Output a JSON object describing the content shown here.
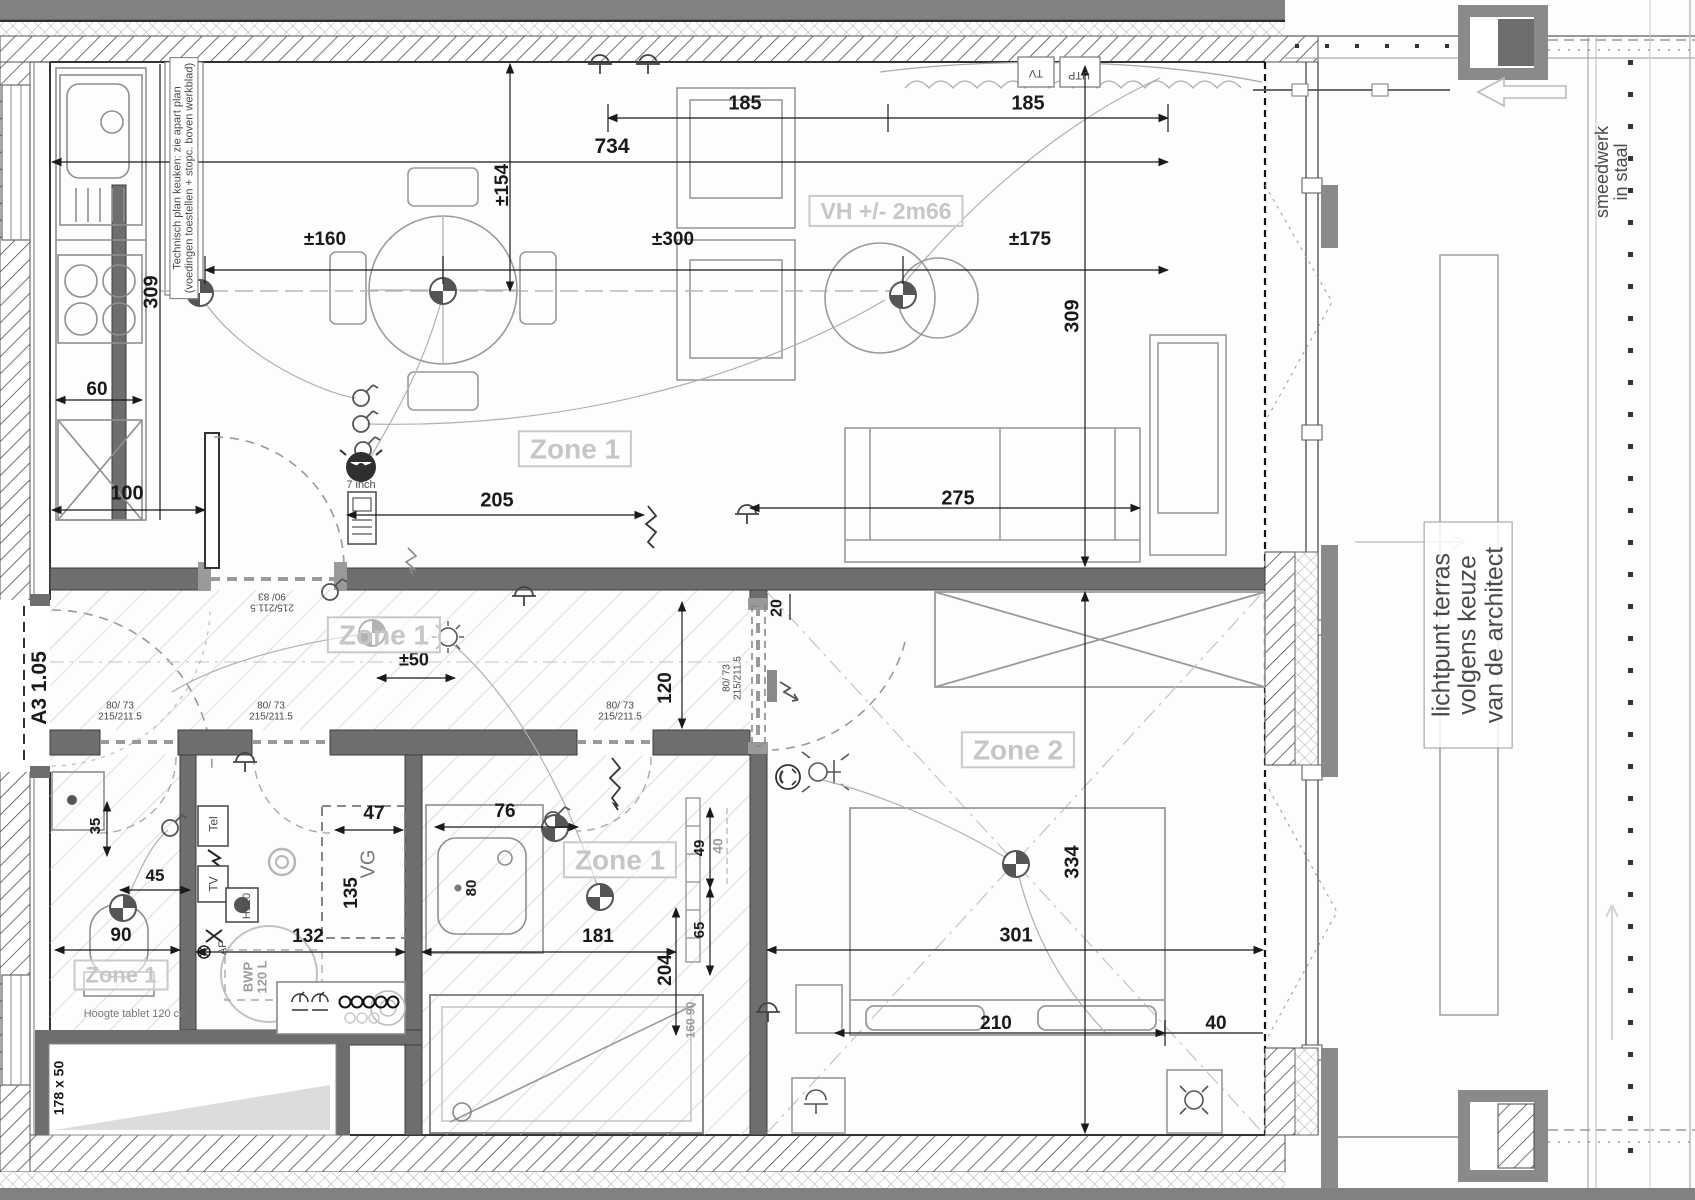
{
  "drawing": {
    "type": "architectural floor plan - apartment electrical / technical plan",
    "scale_note": "dimensions in cm",
    "colors": {
      "wall_fill": "#6e6e6e",
      "outer_band": "#818181",
      "dim_text": "#1a1a1a",
      "zone_text": "#c6c6c6",
      "grey_text": "#9b9b9b",
      "furniture_line": "#999999"
    }
  },
  "labels": [
    {
      "id": "dim-185-left",
      "text": "185",
      "x": 745,
      "y": 104,
      "rot": 0,
      "size": 20,
      "cls": "c-dim"
    },
    {
      "id": "dim-185-right",
      "text": "185",
      "x": 1028,
      "y": 104,
      "rot": 0,
      "size": 20,
      "cls": "c-dim"
    },
    {
      "id": "dim-734",
      "text": "734",
      "x": 612,
      "y": 147,
      "rot": 0,
      "size": 21,
      "cls": "c-dim"
    },
    {
      "id": "dim-154",
      "text": "±154",
      "x": 503,
      "y": 185,
      "rot": -90,
      "size": 19,
      "cls": "c-dim"
    },
    {
      "id": "dim-160",
      "text": "±160",
      "x": 325,
      "y": 240,
      "rot": 0,
      "size": 19,
      "cls": "c-dim"
    },
    {
      "id": "dim-300",
      "text": "±300",
      "x": 673,
      "y": 240,
      "rot": 0,
      "size": 19,
      "cls": "c-dim"
    },
    {
      "id": "dim-175",
      "text": "±175",
      "x": 1030,
      "y": 240,
      "rot": 0,
      "size": 19,
      "cls": "c-dim"
    },
    {
      "id": "dim-309-left",
      "text": "309",
      "x": 152,
      "y": 292,
      "rot": -90,
      "size": 20,
      "cls": "c-dim"
    },
    {
      "id": "dim-309-right",
      "text": "309",
      "x": 1073,
      "y": 316,
      "rot": -90,
      "size": 20,
      "cls": "c-dim"
    },
    {
      "id": "dim-275",
      "text": "275",
      "x": 958,
      "y": 499,
      "rot": 0,
      "size": 20,
      "cls": "c-dim"
    },
    {
      "id": "dim-205",
      "text": "205",
      "x": 497,
      "y": 501,
      "rot": 0,
      "size": 20,
      "cls": "c-dim"
    },
    {
      "id": "dim-100",
      "text": "100",
      "x": 127,
      "y": 494,
      "rot": 0,
      "size": 20,
      "cls": "c-dim"
    },
    {
      "id": "dim-60",
      "text": "60",
      "x": 97,
      "y": 390,
      "rot": 0,
      "size": 19,
      "cls": "c-dim"
    },
    {
      "id": "dim-120-hall",
      "text": "120",
      "x": 666,
      "y": 688,
      "rot": -90,
      "size": 19,
      "cls": "c-dim"
    },
    {
      "id": "dim-20",
      "text": "20",
      "x": 778,
      "y": 608,
      "rot": -90,
      "size": 16,
      "cls": "c-dim"
    },
    {
      "id": "dim-50",
      "text": "±50",
      "x": 414,
      "y": 660,
      "rot": 0,
      "size": 18,
      "cls": "c-dim"
    },
    {
      "id": "dim-35",
      "text": "35",
      "x": 96,
      "y": 826,
      "rot": -90,
      "size": 15,
      "cls": "c-dim"
    },
    {
      "id": "dim-45",
      "text": "45",
      "x": 155,
      "y": 876,
      "rot": 0,
      "size": 17,
      "cls": "c-dim"
    },
    {
      "id": "dim-90",
      "text": "90",
      "x": 121,
      "y": 936,
      "rot": 0,
      "size": 19,
      "cls": "c-dim"
    },
    {
      "id": "dim-132",
      "text": "132",
      "x": 308,
      "y": 937,
      "rot": 0,
      "size": 19,
      "cls": "c-dim"
    },
    {
      "id": "dim-47",
      "text": "47",
      "x": 374,
      "y": 814,
      "rot": 0,
      "size": 19,
      "cls": "c-dim"
    },
    {
      "id": "dim-135",
      "text": "135",
      "x": 352,
      "y": 893,
      "rot": -90,
      "size": 19,
      "cls": "c-dim"
    },
    {
      "id": "dim-76",
      "text": "76",
      "x": 505,
      "y": 812,
      "rot": 0,
      "size": 19,
      "cls": "c-dim"
    },
    {
      "id": "dim-80",
      "text": "80",
      "x": 472,
      "y": 888,
      "rot": -90,
      "size": 15,
      "cls": "c-dim"
    },
    {
      "id": "dim-181",
      "text": "181",
      "x": 598,
      "y": 937,
      "rot": 0,
      "size": 19,
      "cls": "c-dim"
    },
    {
      "id": "dim-204",
      "text": "204",
      "x": 666,
      "y": 970,
      "rot": -90,
      "size": 19,
      "cls": "c-dim"
    },
    {
      "id": "dim-49",
      "text": "49",
      "x": 700,
      "y": 848,
      "rot": -90,
      "size": 15,
      "cls": "c-dim"
    },
    {
      "id": "dim-65",
      "text": "65",
      "x": 700,
      "y": 930,
      "rot": -90,
      "size": 15,
      "cls": "c-dim"
    },
    {
      "id": "dim-40-grey",
      "text": "40",
      "x": 718,
      "y": 846,
      "rot": -90,
      "size": 14,
      "cls": "c-grey"
    },
    {
      "id": "dim-160-90",
      "text": "160  90",
      "x": 691,
      "y": 1020,
      "rot": -90,
      "size": 12,
      "cls": "c-grey"
    },
    {
      "id": "dim-301",
      "text": "301",
      "x": 1016,
      "y": 936,
      "rot": 0,
      "size": 20,
      "cls": "c-dim"
    },
    {
      "id": "dim-334",
      "text": "334",
      "x": 1073,
      "y": 862,
      "rot": -90,
      "size": 20,
      "cls": "c-dim"
    },
    {
      "id": "dim-210",
      "text": "210",
      "x": 996,
      "y": 1024,
      "rot": 0,
      "size": 19,
      "cls": "c-dim"
    },
    {
      "id": "dim-40-bed",
      "text": "40",
      "x": 1216,
      "y": 1024,
      "rot": 0,
      "size": 19,
      "cls": "c-dim"
    },
    {
      "id": "dim-178x50",
      "text": "178 x 50",
      "x": 59,
      "y": 1088,
      "rot": -90,
      "size": 14,
      "cls": "c-dim"
    },
    {
      "id": "zone1-living",
      "text": "Zone 1",
      "x": 575,
      "y": 449,
      "rot": 0,
      "size": 28,
      "cls": "c-zone boxed"
    },
    {
      "id": "zone1-hall",
      "text": "Zone 1",
      "x": 384,
      "y": 635,
      "rot": 0,
      "size": 28,
      "cls": "c-zone boxed"
    },
    {
      "id": "zone2-bedroom",
      "text": "Zone 2",
      "x": 1018,
      "y": 750,
      "rot": 0,
      "size": 28,
      "cls": "c-zone boxed"
    },
    {
      "id": "zone1-bath",
      "text": "Zone 1",
      "x": 620,
      "y": 860,
      "rot": 0,
      "size": 28,
      "cls": "c-zone boxed"
    },
    {
      "id": "zone1-wc",
      "text": "Zone 1",
      "x": 121,
      "y": 975,
      "rot": 0,
      "size": 22,
      "cls": "c-zone boxed"
    },
    {
      "id": "vh-height",
      "text": "VH +/- 2m66",
      "x": 886,
      "y": 211,
      "rot": 0,
      "size": 23,
      "cls": "c-zone boxed"
    },
    {
      "id": "note-kitchen",
      "text": "Technisch plan keuken: zie apart plan\n(voedingen toestellen + stopc. boven werkblad)",
      "x": 184,
      "y": 178,
      "rot": -90,
      "size": 11,
      "cls": "c-note notebox"
    },
    {
      "id": "note-7inch",
      "text": "7 inch",
      "x": 361,
      "y": 486,
      "rot": 0,
      "size": 11,
      "cls": "c-note"
    },
    {
      "id": "note-hoogte-tablet",
      "text": "Hoogte tablet 120 cm",
      "x": 136,
      "y": 1015,
      "rot": 0,
      "size": 11,
      "cls": "c-soft"
    },
    {
      "id": "door-a3",
      "text": "A3 1.05",
      "x": 40,
      "y": 688,
      "rot": -90,
      "size": 21,
      "cls": "c-dim"
    },
    {
      "id": "note-lichtpunt",
      "text": "lichtpunt terras volgens keuze van de architect",
      "x": 1468,
      "y": 635,
      "rot": -90,
      "size": 25,
      "cls": "c-note lightbox"
    },
    {
      "id": "note-smeedwerk",
      "text": "smeedwerk in staal",
      "x": 1612,
      "y": 172,
      "rot": -90,
      "size": 18,
      "cls": "c-note"
    },
    {
      "id": "door-90-83",
      "text": "215/211.5\n90/ 83",
      "x": 272,
      "y": 601,
      "rot": 180,
      "size": 10,
      "cls": "c-note"
    },
    {
      "id": "door-80-73-wc",
      "text": "80/ 73\n215/211.5",
      "x": 120,
      "y": 712,
      "rot": 0,
      "size": 10,
      "cls": "c-note"
    },
    {
      "id": "door-80-73-tech",
      "text": "80/ 73\n215/211.5",
      "x": 271,
      "y": 712,
      "rot": 0,
      "size": 10,
      "cls": "c-note"
    },
    {
      "id": "door-80-73-bath",
      "text": "80/ 73\n215/211.5",
      "x": 620,
      "y": 712,
      "rot": 0,
      "size": 10,
      "cls": "c-note"
    },
    {
      "id": "door-80-73-bed",
      "text": "80/ 73\n215/211.5",
      "x": 733,
      "y": 678,
      "rot": -90,
      "size": 10,
      "cls": "c-note"
    },
    {
      "id": "tech-tel",
      "text": "Tel",
      "x": 214,
      "y": 824,
      "rot": -90,
      "size": 12,
      "cls": "c-note"
    },
    {
      "id": "tech-tv",
      "text": "TV",
      "x": 214,
      "y": 884,
      "rot": -90,
      "size": 12,
      "cls": "c-note"
    },
    {
      "id": "tech-h120",
      "text": "H120",
      "x": 248,
      "y": 906,
      "rot": -90,
      "size": 11,
      "cls": "c-note"
    },
    {
      "id": "tech-af",
      "text": "AF",
      "x": 224,
      "y": 948,
      "rot": -90,
      "size": 11,
      "cls": "c-note"
    },
    {
      "id": "tech-bwp",
      "text": "BWP\n120 L",
      "x": 255,
      "y": 977,
      "rot": -90,
      "size": 13,
      "cls": "c-grey"
    },
    {
      "id": "tech-vg",
      "text": "VG",
      "x": 369,
      "y": 864,
      "rot": -90,
      "size": 20,
      "cls": "c-soft"
    },
    {
      "id": "wall-tv",
      "text": "TV",
      "x": 1036,
      "y": 72,
      "rot": 180,
      "size": 11,
      "cls": "c-note"
    },
    {
      "id": "wall-utp",
      "text": "UTP",
      "x": 1079,
      "y": 74,
      "rot": 180,
      "size": 11,
      "cls": "c-note"
    }
  ]
}
